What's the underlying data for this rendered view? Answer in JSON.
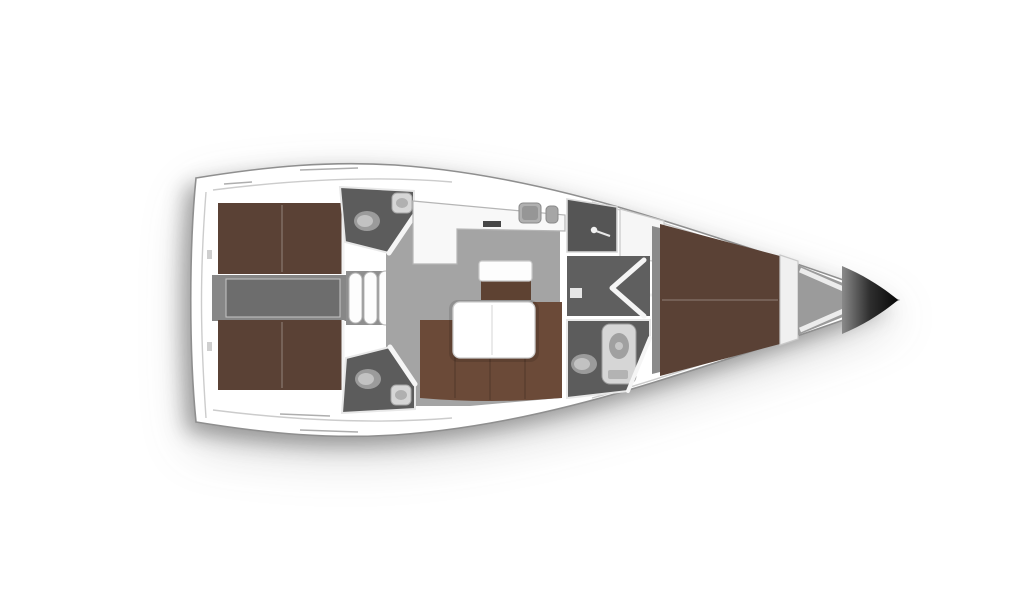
{
  "meta": {
    "title": "Sailing yacht interior layout — top-down floor plan",
    "view": "overhead 3D-rendered deck plan, bow pointing right",
    "regions": [
      "aft-port-cabin-berth",
      "aft-starboard-cabin-berth",
      "engine-compartment",
      "companionway-steps",
      "aft-port-head",
      "aft-starboard-head",
      "galley",
      "salon-dinette",
      "wardrobe",
      "mid-corridor",
      "forward-head-with-shower",
      "forward-owner-cabin-berth",
      "anchor-locker",
      "bow"
    ]
  },
  "palette": {
    "background": "#ffffff",
    "hullFill": "#ffffff",
    "hullStroke": "#8f8f8f",
    "seamLine": "#c3c3c3",
    "deckLine": "#9a9a9a",
    "salonFloor": "#a4a4a4",
    "aftFloor": "#8f8f8f",
    "engineOuter": "#878787",
    "engineInner": "#6d6d6d",
    "corridorFloor": "#5f5f5f",
    "wardrobeFloor": "#555555",
    "headFloor": "#5c5c5c",
    "cabinFloor": "#8a8a8a",
    "anchorFloor": "#9b9b9b",
    "berthBrown": "#5a4135",
    "sofaBrown": "#6b4a38",
    "benchBrown": "#5e4232",
    "cushionWhite": "#fdfdfd",
    "counterWhite": "#f8f8f8",
    "tableWhite": "#ffffff",
    "fixtureLight": "#d6d6d6",
    "fixtureGray": "#9b9b9b",
    "sinkGray": "#b0b0b0",
    "cooktopDark": "#474747",
    "doorWhite": "#f5f5f5",
    "ribWhite": "#ececec",
    "thresholdWhite": "#e6e6e6",
    "bowDarkStart": "#8a8a8a",
    "bowDarkMid": "#2e2e2e",
    "bowDarkEnd": "#070707"
  }
}
